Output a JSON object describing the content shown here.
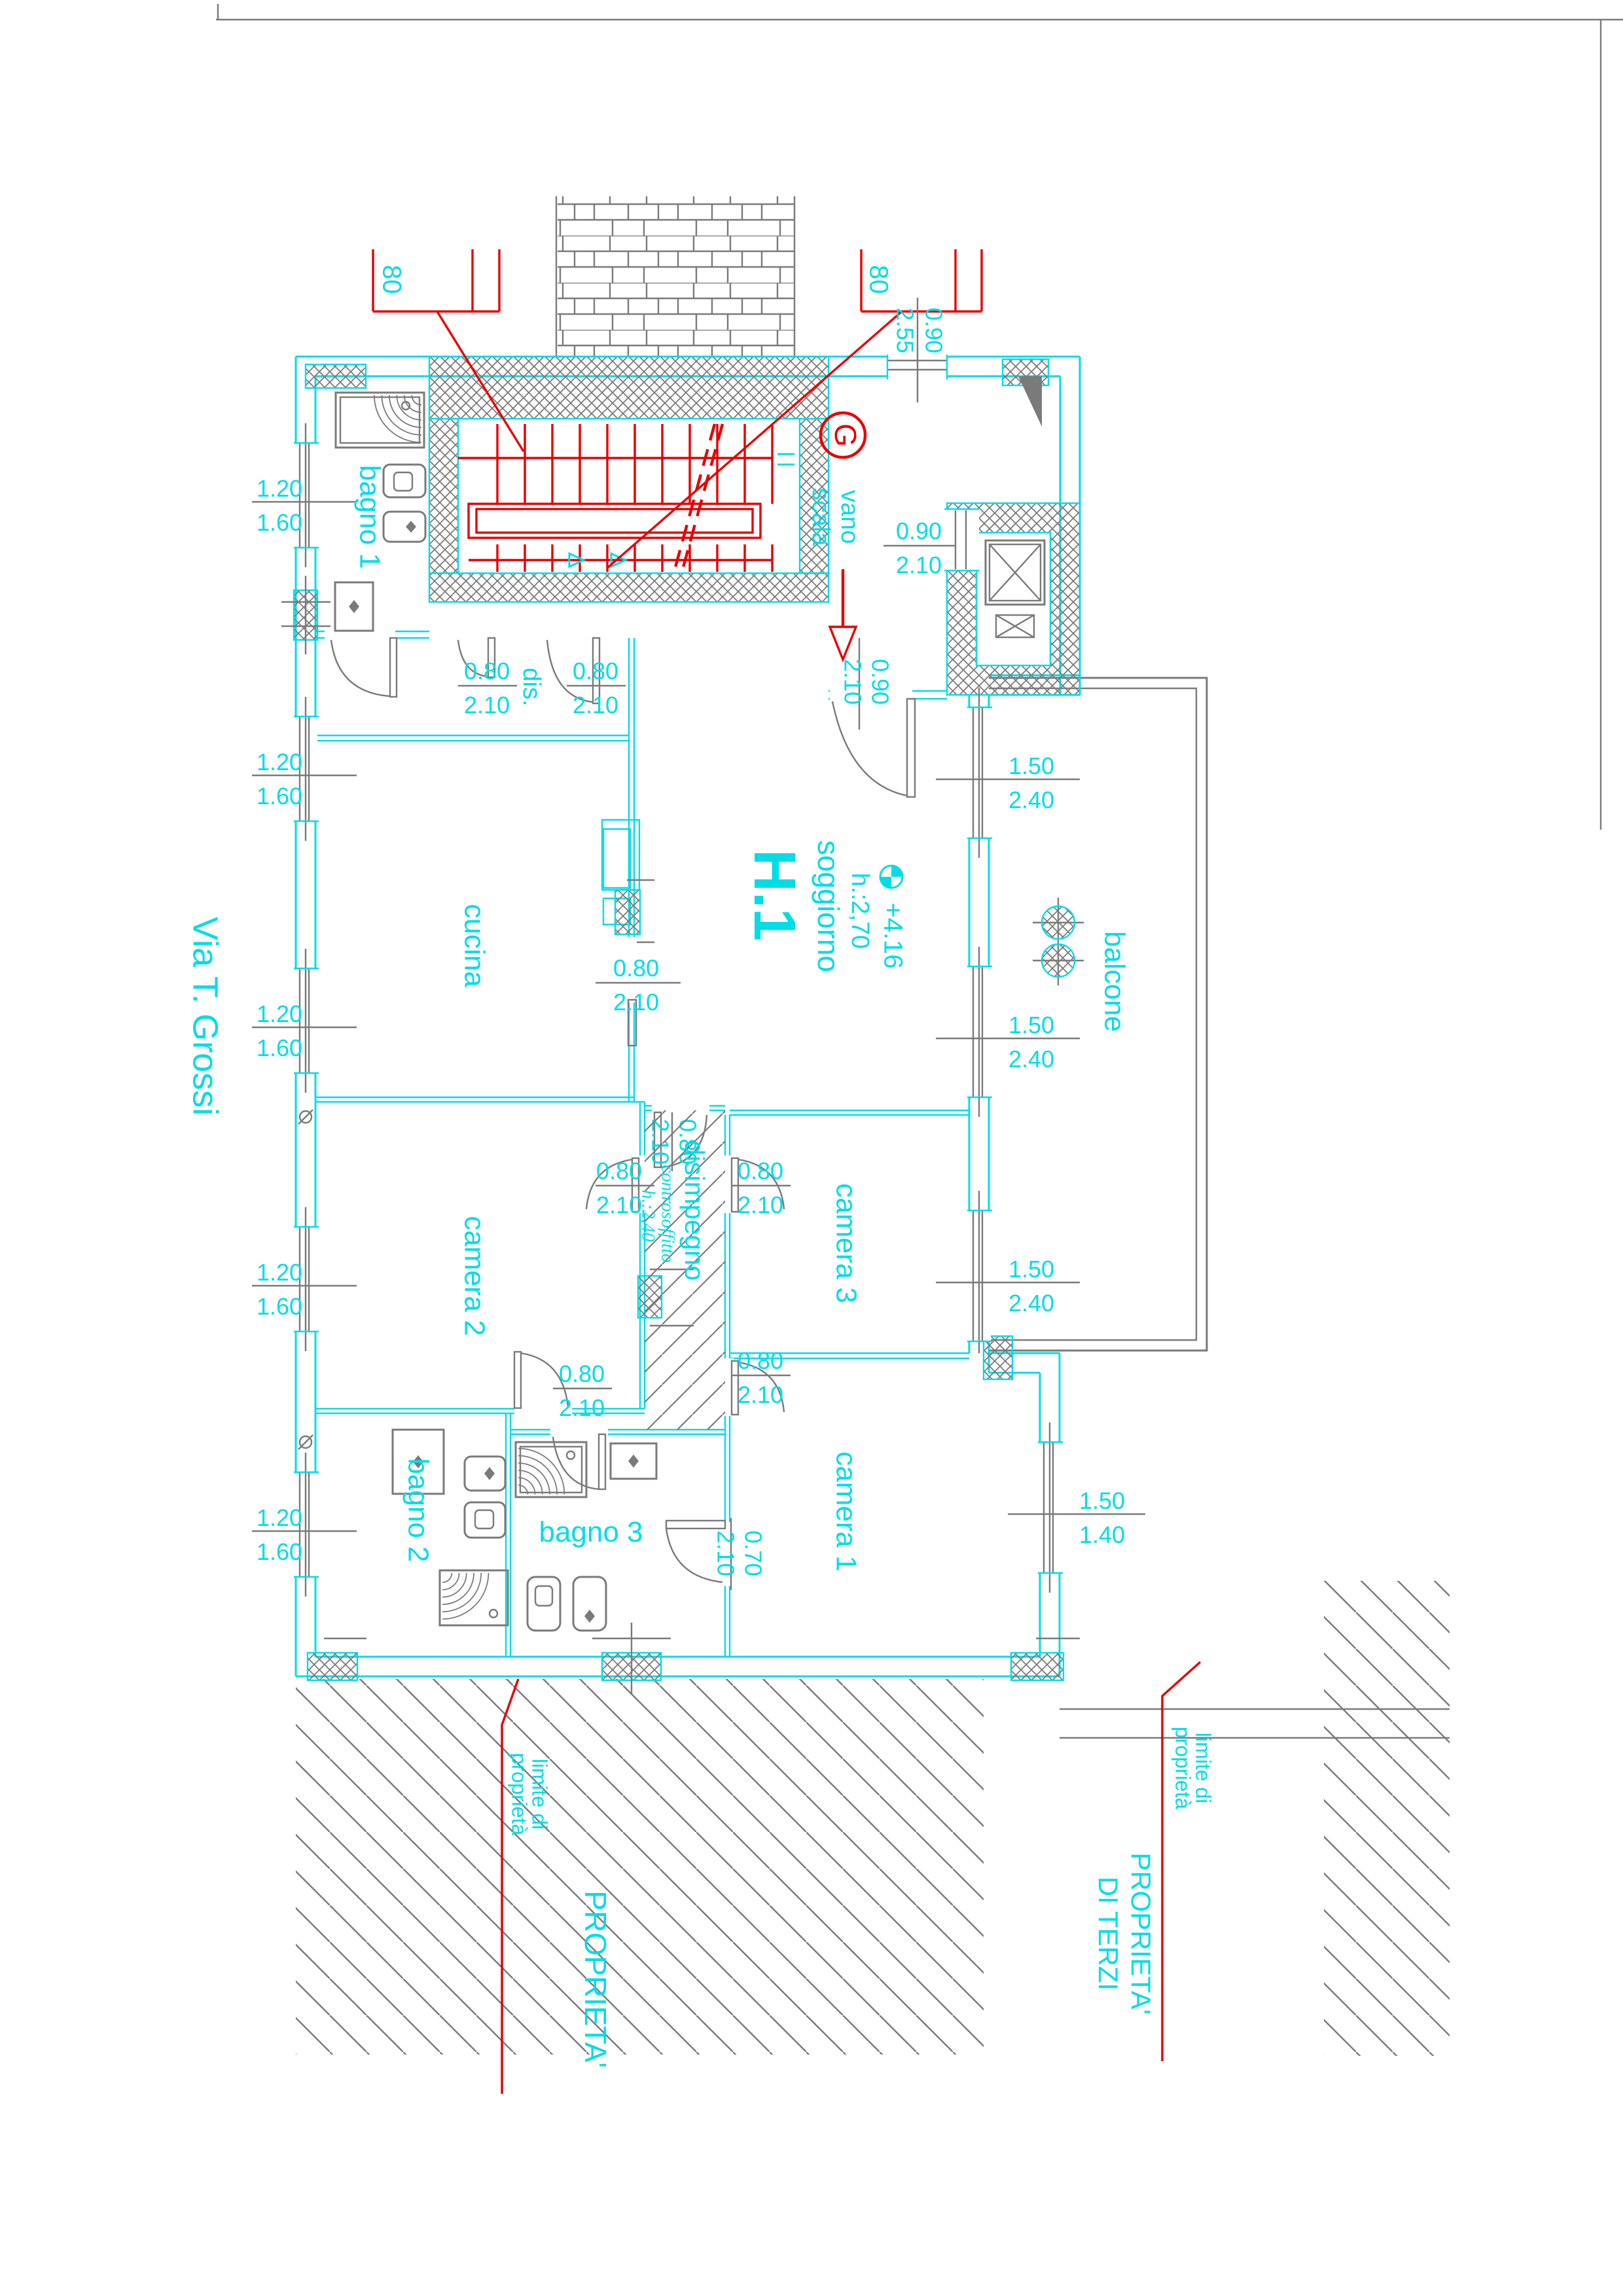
{
  "colors": {
    "cyan": "#00dde6",
    "red": "#e80000",
    "gray": "#7a7a7a"
  },
  "street": {
    "label": "Via T. Grossi"
  },
  "unit": {
    "id": "H.1",
    "room": "soggiorno",
    "ceiling": "h.:2,70",
    "level": "+4.16"
  },
  "rooms": {
    "bagno1": "bagno 1",
    "cucina": "cucina",
    "camera2": "camera 2",
    "bagno2": "bagno 2",
    "bagno3": "bagno 3",
    "camera3": "camera 3",
    "camera1": "camera 1",
    "balcone": "balcone",
    "dis": "dis.",
    "disimpegno": "disimpegno",
    "controsoffitto": "controsoffitto",
    "controsoffitto_h": "h.:2,40"
  },
  "stairwell": {
    "mark": "G",
    "vano": "vano",
    "scala": "scala",
    "flight_width": "80"
  },
  "dims": {
    "d070": "0.70",
    "d080": "0.80",
    "d090": "0.90",
    "d120": "1.20",
    "d140": "1.40",
    "d150": "1.50",
    "d160": "1.60",
    "d210": "2.10",
    "d240": "2.40",
    "d255": "2.55"
  },
  "site": {
    "property": "PROPRIETA'",
    "third_party_1": "PROPRIETA'",
    "third_party_2": "DI TERZI",
    "boundary_1": "limite di",
    "boundary_2": "proprietà"
  }
}
